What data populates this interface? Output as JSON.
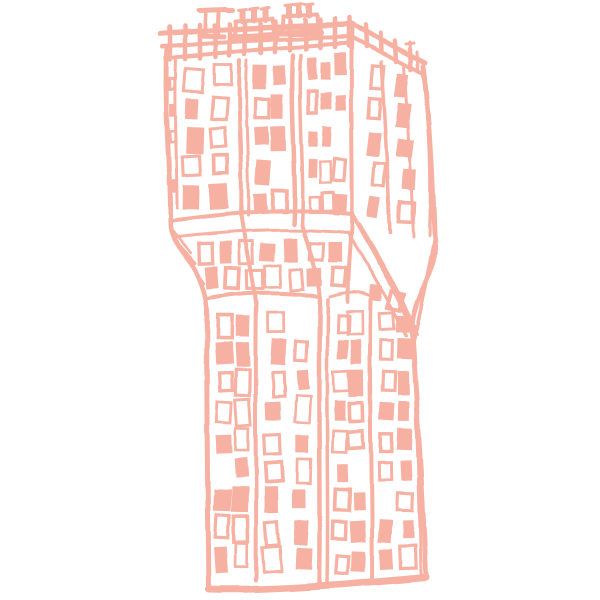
{
  "page": {
    "background_color": "#ffffff"
  },
  "illustration": {
    "name": "hand-drawn crumpled high-rise building sketch",
    "ink_color": "#f6b1a3",
    "seed": 1337,
    "window_sections": [
      {
        "id": "trim-band-left",
        "tl": [
          169,
          72
        ],
        "tr": [
          175,
          72
        ],
        "bl": [
          171,
          200
        ],
        "br": [
          177,
          200
        ],
        "rows": 5,
        "cols": 1,
        "w": 6,
        "h": 11,
        "fill": 0.5,
        "presence": 0.9
      },
      {
        "id": "upper-facade-left",
        "tl": [
          181,
          66
        ],
        "tr": [
          233,
          60
        ],
        "bl": [
          177,
          212
        ],
        "br": [
          236,
          212
        ],
        "rows": 5,
        "cols": 2,
        "w": 15,
        "h": 22,
        "fill": 0.6,
        "presence": 0.95
      },
      {
        "id": "upper-facade-middle",
        "tl": [
          252,
          60
        ],
        "tr": [
          287,
          56
        ],
        "bl": [
          253,
          217
        ],
        "br": [
          290,
          218
        ],
        "rows": 5,
        "cols": 2,
        "w": 13,
        "h": 21,
        "fill": 0.55,
        "presence": 0.95
      },
      {
        "id": "upper-facade-right",
        "tl": [
          306,
          54
        ],
        "tr": [
          346,
          49
        ],
        "bl": [
          307,
          219
        ],
        "br": [
          348,
          220
        ],
        "rows": 5,
        "cols": 3,
        "w": 10,
        "h": 18,
        "fill": 0.5,
        "presence": 0.92
      },
      {
        "id": "side-face-upper",
        "tl": [
          363,
          56
        ],
        "tr": [
          417,
          76
        ],
        "bl": [
          359,
          223
        ],
        "br": [
          425,
          229
        ],
        "rows": 5,
        "cols": 2,
        "w": 13,
        "h": 20,
        "fill": 0.55,
        "presence": 0.9,
        "rot": 6
      },
      {
        "id": "fold-band-middle",
        "tl": [
          188,
          243
        ],
        "tr": [
          346,
          236
        ],
        "bl": [
          206,
          289
        ],
        "br": [
          349,
          293
        ],
        "rows": 2,
        "cols": 7,
        "w": 13,
        "h": 19,
        "fill": 0.5,
        "presence": 0.85
      },
      {
        "id": "fold-band-right",
        "tl": [
          359,
          245
        ],
        "tr": [
          414,
          259
        ],
        "bl": [
          365,
          305
        ],
        "br": [
          408,
          324
        ],
        "rows": 2,
        "cols": 2,
        "w": 11,
        "h": 15,
        "fill": 0.5,
        "presence": 0.7,
        "rot": 9
      },
      {
        "id": "lower-shaft-col-1",
        "tl": [
          217,
          311
        ],
        "tr": [
          249,
          309
        ],
        "bl": [
          214,
          573
        ],
        "br": [
          251,
          571
        ],
        "rows": 9,
        "cols": 2,
        "w": 14,
        "h": 21,
        "fill": 0.55,
        "presence": 0.94
      },
      {
        "id": "lower-shaft-col-2",
        "tl": [
          264,
          309
        ],
        "tr": [
          312,
          307
        ],
        "bl": [
          260,
          576
        ],
        "br": [
          316,
          575
        ],
        "rows": 9,
        "cols": 2,
        "w": 14,
        "h": 21,
        "fill": 0.55,
        "presence": 0.94
      },
      {
        "id": "lower-shaft-col-3",
        "tl": [
          335,
          307
        ],
        "tr": [
          364,
          305
        ],
        "bl": [
          332,
          578
        ],
        "br": [
          366,
          577
        ],
        "rows": 9,
        "cols": 2,
        "w": 13,
        "h": 21,
        "fill": 0.55,
        "presence": 0.94
      },
      {
        "id": "lower-shaft-col-4",
        "tl": [
          380,
          305
        ],
        "tr": [
          411,
          307
        ],
        "bl": [
          377,
          576
        ],
        "br": [
          417,
          573
        ],
        "rows": 9,
        "cols": 2,
        "w": 13,
        "h": 20,
        "fill": 0.55,
        "presence": 0.94
      }
    ]
  }
}
